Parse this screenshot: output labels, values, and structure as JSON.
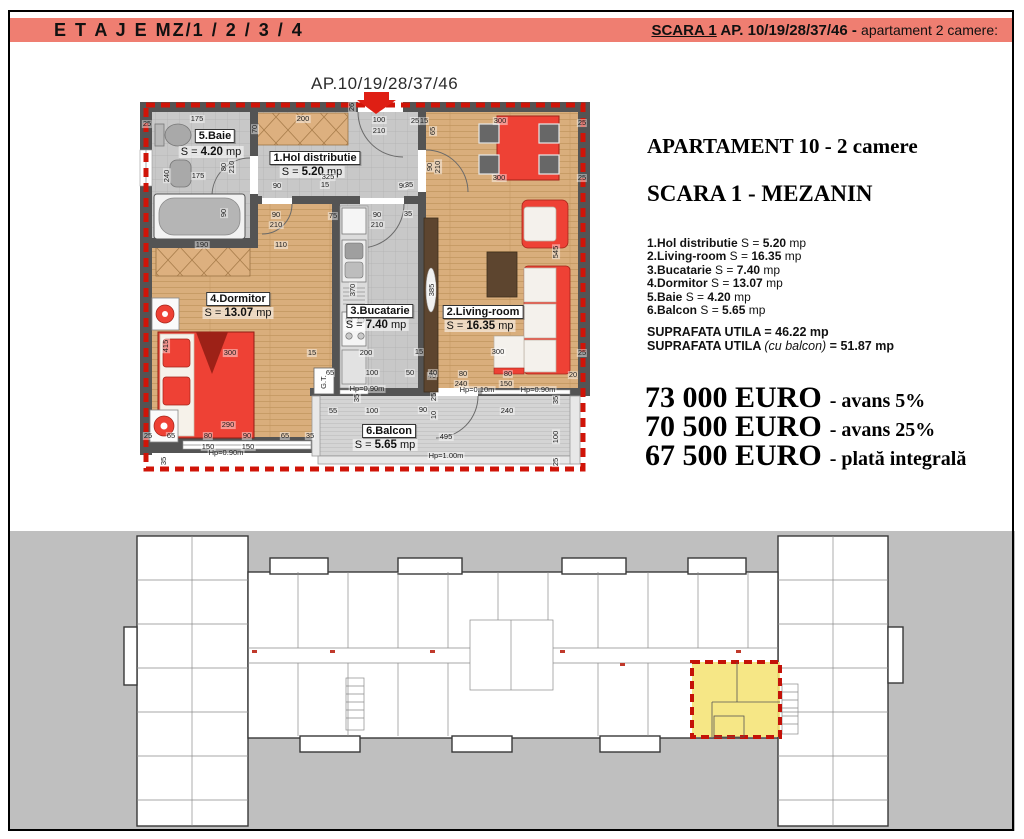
{
  "header": {
    "left": "E T A J E   MZ/1 / 2 / 3 / 4",
    "scara": "SCARA 1",
    "right_bold": " AP. 10/19/28/37/46 - ",
    "right_light": "apartament 2 camere:",
    "bg_color": "#ef7e71"
  },
  "plan": {
    "title": "AP.10/19/28/37/46",
    "eq": "S =",
    "unit": "mp",
    "rooms": [
      {
        "name": "5.Baie",
        "val": "4.20",
        "x": 215,
        "y": 136,
        "ax": 211,
        "ay": 152
      },
      {
        "name": "1.Hol distributie",
        "val": "5.20",
        "x": 315,
        "y": 158,
        "ax": 312,
        "ay": 172
      },
      {
        "name": "4.Dormitor",
        "val": "13.07",
        "x": 238,
        "y": 299,
        "ax": 238,
        "ay": 313
      },
      {
        "name": "3.Bucatarie",
        "val": "7.40",
        "x": 380,
        "y": 311,
        "ax": 376,
        "ay": 325
      },
      {
        "name": "2.Living-room",
        "val": "16.35",
        "x": 483,
        "y": 312,
        "ax": 480,
        "ay": 326
      },
      {
        "name": "6.Balcon",
        "val": "5.65",
        "x": 389,
        "y": 431,
        "ax": 385,
        "ay": 445
      }
    ],
    "dims": [
      {
        "t": "175",
        "x": 197,
        "y": 119
      },
      {
        "t": "200",
        "x": 303,
        "y": 119
      },
      {
        "t": "100",
        "x": 379,
        "y": 120
      },
      {
        "t": "210",
        "x": 379,
        "y": 131
      },
      {
        "t": "25",
        "x": 415,
        "y": 121
      },
      {
        "t": "15",
        "x": 424,
        "y": 121
      },
      {
        "t": "300",
        "x": 500,
        "y": 121
      },
      {
        "t": "25",
        "x": 582,
        "y": 123
      },
      {
        "t": "26",
        "x": 352,
        "y": 107,
        "r": 1
      },
      {
        "t": "70",
        "x": 255,
        "y": 129,
        "r": 1
      },
      {
        "t": "65",
        "x": 433,
        "y": 131,
        "r": 1
      },
      {
        "t": "25",
        "x": 147,
        "y": 124
      },
      {
        "t": "175",
        "x": 198,
        "y": 176
      },
      {
        "t": "240",
        "x": 167,
        "y": 176,
        "r": 1
      },
      {
        "t": "80",
        "x": 224,
        "y": 167,
        "r": 1
      },
      {
        "t": "210",
        "x": 232,
        "y": 167,
        "r": 1
      },
      {
        "t": "90",
        "x": 224,
        "y": 213,
        "r": 1
      },
      {
        "t": "190",
        "x": 202,
        "y": 245
      },
      {
        "t": "325",
        "x": 328,
        "y": 177
      },
      {
        "t": "15",
        "x": 325,
        "y": 185
      },
      {
        "t": "90",
        "x": 277,
        "y": 186
      },
      {
        "t": "90",
        "x": 403,
        "y": 186
      },
      {
        "t": "35",
        "x": 409,
        "y": 185
      },
      {
        "t": "110",
        "x": 281,
        "y": 245
      },
      {
        "t": "90",
        "x": 276,
        "y": 215
      },
      {
        "t": "210",
        "x": 276,
        "y": 225
      },
      {
        "t": "75",
        "x": 333,
        "y": 216
      },
      {
        "t": "90",
        "x": 377,
        "y": 215
      },
      {
        "t": "210",
        "x": 377,
        "y": 225
      },
      {
        "t": "35",
        "x": 408,
        "y": 214
      },
      {
        "t": "90",
        "x": 430,
        "y": 167,
        "r": 1
      },
      {
        "t": "210",
        "x": 438,
        "y": 167,
        "r": 1
      },
      {
        "t": "300",
        "x": 499,
        "y": 178
      },
      {
        "t": "25",
        "x": 582,
        "y": 178
      },
      {
        "t": "545",
        "x": 556,
        "y": 252,
        "r": 1
      },
      {
        "t": "385",
        "x": 432,
        "y": 290,
        "r": 1
      },
      {
        "t": "300",
        "x": 498,
        "y": 352
      },
      {
        "t": "25",
        "x": 582,
        "y": 353
      },
      {
        "t": "40",
        "x": 432,
        "y": 376
      },
      {
        "t": "80",
        "x": 463,
        "y": 374
      },
      {
        "t": "240",
        "x": 461,
        "y": 384
      },
      {
        "t": "80",
        "x": 508,
        "y": 374
      },
      {
        "t": "150",
        "x": 506,
        "y": 384
      },
      {
        "t": "Hp=0.10m",
        "x": 477,
        "y": 390
      },
      {
        "t": "Hp=0.90m",
        "x": 538,
        "y": 390
      },
      {
        "t": "20",
        "x": 573,
        "y": 375
      },
      {
        "t": "370",
        "x": 353,
        "y": 290,
        "r": 1
      },
      {
        "t": "200",
        "x": 366,
        "y": 353
      },
      {
        "t": "15",
        "x": 312,
        "y": 353
      },
      {
        "t": "15",
        "x": 419,
        "y": 352
      },
      {
        "t": "65",
        "x": 330,
        "y": 373
      },
      {
        "t": "100",
        "x": 372,
        "y": 373
      },
      {
        "t": "50",
        "x": 410,
        "y": 373
      },
      {
        "t": "40",
        "x": 433,
        "y": 373
      },
      {
        "t": "Hp=0.90m",
        "x": 367,
        "y": 389
      },
      {
        "t": "G.T.",
        "x": 324,
        "y": 382,
        "r": 1
      },
      {
        "t": "415",
        "x": 166,
        "y": 346,
        "r": 1
      },
      {
        "t": "300",
        "x": 230,
        "y": 353
      },
      {
        "t": "290",
        "x": 228,
        "y": 425
      },
      {
        "t": "65",
        "x": 171,
        "y": 436
      },
      {
        "t": "80",
        "x": 208,
        "y": 436
      },
      {
        "t": "90",
        "x": 247,
        "y": 436
      },
      {
        "t": "65",
        "x": 285,
        "y": 436
      },
      {
        "t": "35",
        "x": 310,
        "y": 436
      },
      {
        "t": "150",
        "x": 208,
        "y": 447
      },
      {
        "t": "150",
        "x": 248,
        "y": 447
      },
      {
        "t": "Hp=0.90m",
        "x": 226,
        "y": 453
      },
      {
        "t": "25",
        "x": 148,
        "y": 436
      },
      {
        "t": "35",
        "x": 164,
        "y": 461,
        "r": 1
      },
      {
        "t": "55",
        "x": 333,
        "y": 411
      },
      {
        "t": "100",
        "x": 372,
        "y": 411
      },
      {
        "t": "90",
        "x": 423,
        "y": 410
      },
      {
        "t": "10",
        "x": 434,
        "y": 415,
        "r": 1
      },
      {
        "t": "240",
        "x": 507,
        "y": 411
      },
      {
        "t": "495",
        "x": 446,
        "y": 437
      },
      {
        "t": "Hp=1.00m",
        "x": 446,
        "y": 456
      },
      {
        "t": "100",
        "x": 556,
        "y": 437,
        "r": 1
      },
      {
        "t": "35",
        "x": 556,
        "y": 400,
        "r": 1
      },
      {
        "t": "25",
        "x": 556,
        "y": 462,
        "r": 1
      },
      {
        "t": "35",
        "x": 357,
        "y": 398,
        "r": 1
      },
      {
        "t": "25",
        "x": 434,
        "y": 397,
        "r": 1
      }
    ]
  },
  "panel": {
    "title": "APARTAMENT 10 - 2 camere",
    "subtitle": "SCARA 1 - MEZANIN",
    "eq": "S =",
    "unit": "mp",
    "rooms": [
      {
        "name": "1.Hol distributie",
        "val": "5.20"
      },
      {
        "name": "2.Living-room",
        "val": "16.35"
      },
      {
        "name": "3.Bucatarie",
        "val": "7.40"
      },
      {
        "name": "4.Dormitor",
        "val": "13.07"
      },
      {
        "name": "5.Baie",
        "val": "4.20"
      },
      {
        "name": "6.Balcon",
        "val": "5.65"
      }
    ],
    "totals": [
      {
        "label": "SUPRAFATA UTILA",
        "paren": "",
        "mid": "=",
        "val": "46.22 mp"
      },
      {
        "label": "SUPRAFATA UTILA",
        "paren": "(cu balcon)",
        "mid": "=",
        "val": "51.87 mp"
      }
    ],
    "prices": [
      {
        "amount": "73 000 EURO",
        "note": "- avans 5%"
      },
      {
        "amount": "70 500 EURO",
        "note": "- avans 25%"
      },
      {
        "amount": "67 500 EURO",
        "note": "- plată integrală"
      }
    ]
  },
  "site": {
    "bg_color": "#bfbfbf",
    "highlight_color": "#f5e57c",
    "dash_color": "#c41208"
  }
}
